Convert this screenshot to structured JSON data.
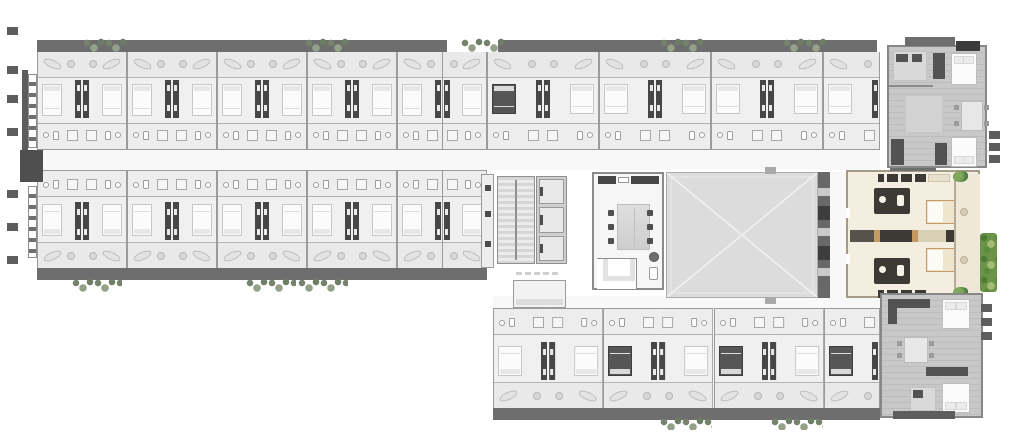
{
  "plan": {
    "type": "architectural-floor-plan",
    "view": "top-down-render",
    "canvas": {
      "width": 1024,
      "height": 439
    }
  },
  "palette": {
    "background": "#ffffff",
    "room_floor": "#f0f0f0",
    "balcony_floor": "#e9e9e9",
    "corridor_floor": "#f8f8f8",
    "wall": "#9b9b9b",
    "core_dark": "#474747",
    "roof_band": "#6e6e6e",
    "courtyard": "#dcdcdc",
    "stair_tread": "#d6d6d6",
    "chair_dark": "#4f4f4f",
    "bed_white": "#fbfbfb",
    "bed_border": "#c6c6c6",
    "bed_dark": "#565656",
    "highlight_floor": "#f4eee0",
    "highlight_accent": "#c59a62",
    "highlight_core": "#3d3a35",
    "wood_floor": "#c8c8c8",
    "wood_line": "#bcbcbc",
    "facade_dark": "#5d5d5d",
    "hedge_green": "#6b9448"
  },
  "wings": {
    "top_row_standard": {
      "label": "standard-guest-rooms",
      "count": 10,
      "dark_bed_indices": []
    },
    "top_row_wide": {
      "label": "suite-rooms",
      "count": 7,
      "dark_bed_indices": [
        0
      ]
    },
    "bottom_row_standard": {
      "label": "standard-guest-rooms",
      "count": 10,
      "dark_bed_indices": []
    },
    "bottom_wing": {
      "label": "guest-rooms",
      "count": 7,
      "dark_bed_indices": [
        2,
        4,
        6
      ]
    }
  },
  "core": {
    "stairs": true,
    "elevators": {
      "count": 3
    }
  },
  "common_room": {
    "chairs_per_side": 3,
    "chair_rows_y": [
      36,
      50,
      64
    ],
    "chair_cols_x": [
      14,
      53
    ]
  },
  "highlight_unit": {
    "selected": true,
    "bedrooms": 2,
    "bathrooms": 2,
    "balcony": true
  },
  "greenery": {
    "top_band_clusters_x": [
      83,
      305,
      461,
      660,
      783
    ],
    "bottom_left_band_clusters_x": [
      72,
      246,
      298
    ],
    "bottom_wing_band_clusters_x": [
      660,
      771
    ]
  },
  "facade": {
    "left_units_y": [
      27,
      66,
      95,
      128,
      190,
      223,
      256
    ],
    "right_units_y": [
      131,
      143,
      155
    ],
    "right_lower_units_y": [
      304,
      318,
      332
    ]
  }
}
